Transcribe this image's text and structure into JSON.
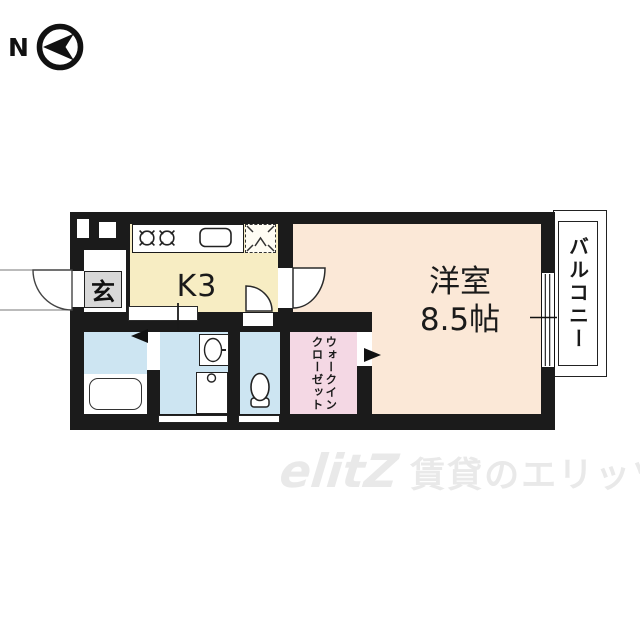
{
  "north": {
    "label": "N"
  },
  "plan": {
    "rooms": {
      "genkan": {
        "label": "玄"
      },
      "kitchen": {
        "label": "K3"
      },
      "main": {
        "name": "洋室",
        "size": "8.5帖"
      },
      "balcony": {
        "label": "バルコニー"
      },
      "closet": {
        "line1": "ウォークイン",
        "line2": "クローゼット"
      }
    },
    "colors": {
      "wall": "#1b1b1b",
      "kitchen": "#f7edc3",
      "main_room": "#fbe8d7",
      "closet": "#f4d8e4",
      "wet_rooms": "#cde5f2",
      "genkan": "#d8d8d8",
      "watermark": "#e9e9e9"
    },
    "icons": {
      "compass": "north-arrow-circle-left",
      "kitchen": [
        "stove-burners",
        "sink",
        "refrigerator-space"
      ],
      "bath": "bathtub",
      "washroom": [
        "washbasin",
        "washing-machine-pan"
      ],
      "toilet": "toilet-bowl",
      "doors": [
        "entrance-door-swing",
        "room-door-swing",
        "toilet-door-swing",
        "bath-door-triangle",
        "closet-door-triangle"
      ],
      "window": "sliding-window"
    }
  },
  "watermark": {
    "logo": "elitZ",
    "text": "賃貸のエリッツ"
  }
}
